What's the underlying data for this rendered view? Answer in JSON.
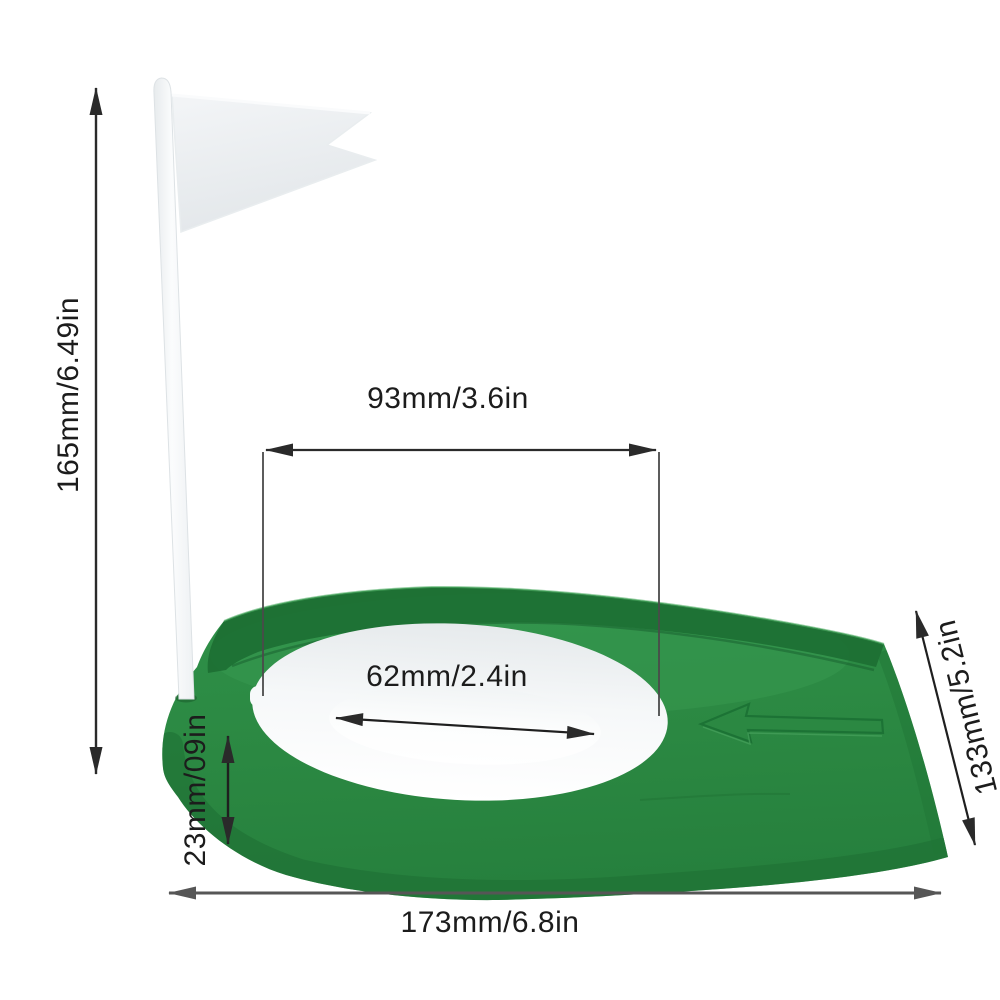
{
  "scene": {
    "description": "Golf putting cup practice hole with flag - product dimension diagram",
    "background": "#ffffff"
  },
  "product": {
    "base_green": "#2c8a43",
    "base_green_light": "#38994f",
    "base_green_dark": "#1d7034",
    "base_green_deep": "#175e2b",
    "ring_white": "#f3f6f7",
    "hole_white": "#fdfefe",
    "flag_white": "#eef1f3",
    "pole_white": "#f9fbfc"
  },
  "annotations": {
    "line_color": "#2a2a2a",
    "extension_line_color": "#4a4a4a",
    "bottom_line_color": "#565656",
    "labels": {
      "height": "165mm/6.49in",
      "top_width": "93mm/3.6in",
      "hole_diameter": "62mm/2.4in",
      "edge_thickness": "23mm/09in",
      "depth": "133mm/5.2in",
      "base_width": "173mm/6.8in"
    }
  }
}
